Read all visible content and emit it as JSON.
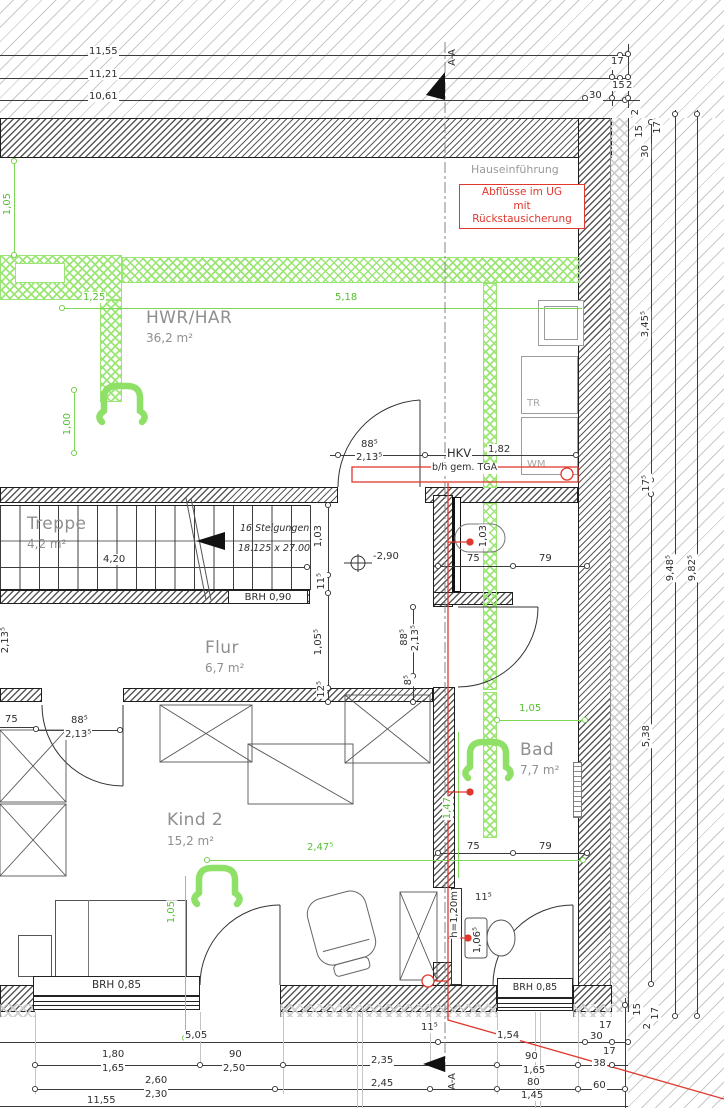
{
  "drawing": {
    "section_label": "A-A",
    "notes": {
      "hauseinfuehrung": "Hauseinführung",
      "abfluesse_1": "Abflüsse im UG",
      "abfluesse_2": "mit Rückstausicherung",
      "hkv": "HKV",
      "hkv_spec": "b/h gem. TGA",
      "level_marker": "-2,90",
      "partition_height": "h=1,20m",
      "stair_count": "16 Steigungen",
      "stair_step": "18.125 x 27.00"
    },
    "appliances": {
      "dryer": "TR",
      "washer": "WM"
    },
    "windows": {
      "stair_parapet": "BRH 0,90",
      "left_parapet": "BRH 0,85",
      "right_parapet": "BRH 0,85"
    },
    "rooms": {
      "hwr": {
        "name": "HWR/HAR",
        "area": "36,2 m²"
      },
      "treppe": {
        "name": "Treppe",
        "area": "4,2 m²"
      },
      "flur": {
        "name": "Flur",
        "area": "6,7 m²"
      },
      "kind2": {
        "name": "Kind 2",
        "area": "15,2 m²"
      },
      "bad": {
        "name": "Bad",
        "area": "7,7 m²"
      }
    },
    "colors": {
      "dim_green": "#56c032",
      "note_red": "#e0382e",
      "room_gray": "#8f8f8f"
    }
  },
  "dim_labels": [
    {
      "t": "11,55",
      "x": 88,
      "y": 46
    },
    {
      "t": "11,21",
      "x": 88,
      "y": 69
    },
    {
      "t": "10,61",
      "x": 88,
      "y": 91
    },
    {
      "t": "17",
      "x": 610,
      "y": 56
    },
    {
      "t": "15",
      "x": 611,
      "y": 80
    },
    {
      "t": "2",
      "x": 625,
      "y": 80
    },
    {
      "t": "30",
      "x": 588,
      "y": 90
    },
    {
      "t": "2",
      "x": 630,
      "y": 108,
      "r": 1
    },
    {
      "t": "15",
      "x": 634,
      "y": 124,
      "r": 1
    },
    {
      "t": "17",
      "x": 652,
      "y": 120,
      "r": 1
    },
    {
      "t": "30",
      "x": 640,
      "y": 144,
      "r": 1
    },
    {
      "t": "3,45⁵",
      "x": 640,
      "y": 310,
      "r": 1
    },
    {
      "t": "17⁵",
      "x": 641,
      "y": 474,
      "r": 1
    },
    {
      "t": "9,48⁵",
      "x": 665,
      "y": 554,
      "r": 1
    },
    {
      "t": "9,82⁵",
      "x": 687,
      "y": 554,
      "r": 1
    },
    {
      "t": "5,38",
      "x": 641,
      "y": 724,
      "r": 1
    },
    {
      "t": "1,05",
      "x": 2,
      "y": 192,
      "r": 1,
      "g": 1
    },
    {
      "t": "1,25",
      "x": 82,
      "y": 292,
      "g": 1
    },
    {
      "t": "5,18",
      "x": 334,
      "y": 292,
      "g": 1
    },
    {
      "t": "1,00",
      "x": 62,
      "y": 412,
      "r": 1,
      "g": 1
    },
    {
      "t": "88⁵",
      "x": 360,
      "y": 439
    },
    {
      "t": "2,13⁵",
      "x": 355,
      "y": 452
    },
    {
      "t": "1,82",
      "x": 487,
      "y": 444
    },
    {
      "t": "1,03",
      "x": 313,
      "y": 524,
      "r": 1
    },
    {
      "t": "11⁵",
      "x": 316,
      "y": 572,
      "r": 1
    },
    {
      "t": "1,05⁵",
      "x": 313,
      "y": 628,
      "r": 1
    },
    {
      "t": "12⁵",
      "x": 316,
      "y": 680,
      "r": 1
    },
    {
      "t": "88⁵",
      "x": 399,
      "y": 628,
      "r": 1
    },
    {
      "t": "2,13⁵",
      "x": 410,
      "y": 624,
      "r": 1
    },
    {
      "t": "8⁵",
      "x": 403,
      "y": 674,
      "r": 1
    },
    {
      "t": "1,03",
      "x": 478,
      "y": 524,
      "r": 1
    },
    {
      "t": "75",
      "x": 466,
      "y": 553
    },
    {
      "t": "79",
      "x": 538,
      "y": 553
    },
    {
      "t": "-2,90",
      "x": 372,
      "y": 551
    },
    {
      "t": "4,20",
      "x": 102,
      "y": 554
    },
    {
      "t": "2,13⁵",
      "x": 0,
      "y": 626,
      "r": 1
    },
    {
      "t": "75",
      "x": 4,
      "y": 714
    },
    {
      "t": "88⁵",
      "x": 70,
      "y": 715
    },
    {
      "t": "2,13⁵",
      "x": 64,
      "y": 729
    },
    {
      "t": "75",
      "x": 466,
      "y": 841
    },
    {
      "t": "79",
      "x": 538,
      "y": 841
    },
    {
      "t": "1,05",
      "x": 518,
      "y": 703,
      "g": 1
    },
    {
      "t": "2,47⁵",
      "x": 306,
      "y": 842,
      "g": 1
    },
    {
      "t": "1,05",
      "x": 166,
      "y": 900,
      "r": 1,
      "g": 1
    },
    {
      "t": "1,47",
      "x": 442,
      "y": 796,
      "r": 1,
      "g": 1
    },
    {
      "t": "11⁵",
      "x": 474,
      "y": 892
    },
    {
      "t": "1,06⁵",
      "x": 472,
      "y": 926,
      "r": 1
    },
    {
      "t": "11⁵",
      "x": 420,
      "y": 1022
    },
    {
      "t": "1,54",
      "x": 496,
      "y": 1030
    },
    {
      "t": "30",
      "x": 589,
      "y": 1031
    },
    {
      "t": "17",
      "x": 598,
      "y": 1020
    },
    {
      "t": "17",
      "x": 602,
      "y": 1046
    },
    {
      "t": "5,05",
      "x": 184,
      "y": 1030
    },
    {
      "t": "1,80",
      "x": 101,
      "y": 1049
    },
    {
      "t": "90",
      "x": 228,
      "y": 1049
    },
    {
      "t": "1,65",
      "x": 101,
      "y": 1063
    },
    {
      "t": "2,50",
      "x": 222,
      "y": 1063
    },
    {
      "t": "2,35",
      "x": 370,
      "y": 1055
    },
    {
      "t": "90",
      "x": 524,
      "y": 1051
    },
    {
      "t": "1,65",
      "x": 522,
      "y": 1065
    },
    {
      "t": "38",
      "x": 592,
      "y": 1058
    },
    {
      "t": "2,60",
      "x": 144,
      "y": 1075
    },
    {
      "t": "2,30",
      "x": 144,
      "y": 1089
    },
    {
      "t": "2,45",
      "x": 370,
      "y": 1078
    },
    {
      "t": "80",
      "x": 526,
      "y": 1077
    },
    {
      "t": "1,45",
      "x": 520,
      "y": 1090
    },
    {
      "t": "60",
      "x": 592,
      "y": 1080
    },
    {
      "t": "11,55",
      "x": 86,
      "y": 1095
    },
    {
      "t": "15",
      "x": 632,
      "y": 1002,
      "r": 1
    },
    {
      "t": "17",
      "x": 650,
      "y": 1006,
      "r": 1
    },
    {
      "t": "2",
      "x": 642,
      "y": 1022,
      "r": 1
    }
  ]
}
